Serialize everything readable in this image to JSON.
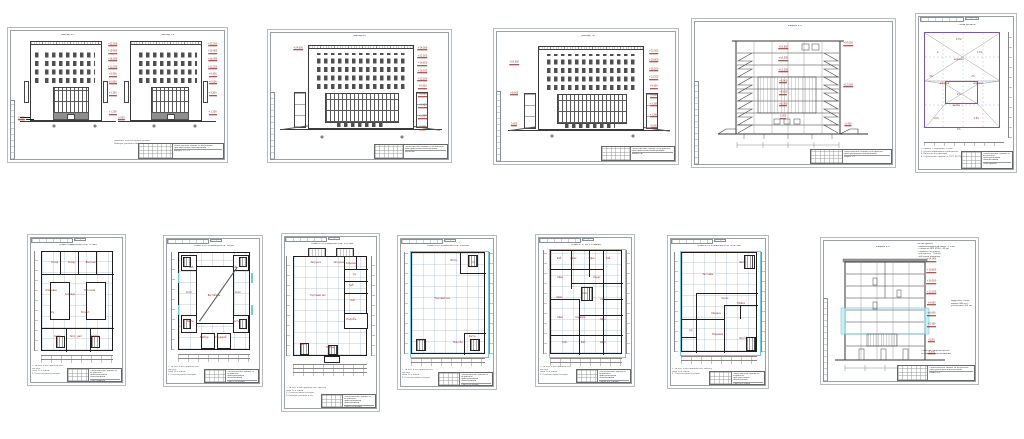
{
  "titleblock": {
    "proj": "Общественное здание со встроенно-\nпристроенными помещениями",
    "list": "Стадия АР  Лист"
  },
  "sheets": {
    "s1": {
      "title_left": "Фасад 1-7",
      "title_right": "Фасад 7-1",
      "stamp": "Фасады 1-7, 7-1",
      "note": "Указания: отметки даны в метрах.\nРазмеры указаны в миллиметрах.",
      "levels": [
        {
          "x": 103,
          "y": 6,
          "t": "+22.500",
          "c": "lvl"
        },
        {
          "x": 103,
          "y": 14,
          "t": "+19.800",
          "c": "lvl"
        },
        {
          "x": 103,
          "y": 22,
          "t": "+16.500",
          "c": "lvl"
        },
        {
          "x": 103,
          "y": 30,
          "t": "+13.200",
          "c": "lvl"
        },
        {
          "x": 103,
          "y": 38,
          "t": "+9.900",
          "c": "lvl"
        },
        {
          "x": 103,
          "y": 46,
          "t": "+6.600",
          "c": "lvl"
        },
        {
          "x": 103,
          "y": 58,
          "t": "+3.300",
          "c": "lvl"
        },
        {
          "x": 103,
          "y": 78,
          "t": "+1.200",
          "c": "lvl"
        },
        {
          "x": -3,
          "y": 84,
          "t": "0.000",
          "c": "lvl"
        },
        {
          "x": 35,
          "y": 92,
          "t": "",
          "c": "axc"
        },
        {
          "x": 83,
          "y": 92,
          "t": "",
          "c": "axc"
        }
      ]
    },
    "s2": {
      "title": "Фасад А-Г",
      "stamp": "Фасад А-Г",
      "levels": [
        {
          "x": 86,
          "y": 8,
          "t": "+24.000",
          "c": "lvl"
        },
        {
          "x": 86,
          "y": 15,
          "t": "+22.500",
          "c": "lvl"
        },
        {
          "x": 86,
          "y": 22,
          "t": "+19.800",
          "c": "lvl"
        },
        {
          "x": 86,
          "y": 29,
          "t": "+16.500",
          "c": "lvl"
        },
        {
          "x": 86,
          "y": 36,
          "t": "+13.200",
          "c": "lvl"
        },
        {
          "x": 86,
          "y": 43,
          "t": "+9.900",
          "c": "lvl"
        },
        {
          "x": 86,
          "y": 50,
          "t": "+6.600",
          "c": "lvl"
        },
        {
          "x": 86,
          "y": 60,
          "t": "+3.300",
          "c": "lvl"
        },
        {
          "x": 86,
          "y": 70,
          "t": "+1.200",
          "c": "lvl"
        },
        {
          "x": 86,
          "y": 80,
          "t": "0.000",
          "c": "lvl"
        },
        {
          "x": 12,
          "y": 8,
          "t": "+24.000",
          "c": "lvl"
        },
        {
          "x": 26,
          "y": 88,
          "t": "",
          "c": "axc"
        },
        {
          "x": 74,
          "y": 88,
          "t": "",
          "c": "axc"
        }
      ]
    },
    "s3": {
      "title": "Фасад Г-А",
      "stamp": "Фасад Г-А",
      "levels": [
        {
          "x": 88,
          "y": 10,
          "t": "+22.500",
          "c": "lvl"
        },
        {
          "x": 88,
          "y": 18,
          "t": "+19.800",
          "c": "lvl"
        },
        {
          "x": 88,
          "y": 26,
          "t": "+16.500",
          "c": "lvl"
        },
        {
          "x": 88,
          "y": 34,
          "t": "+13.200",
          "c": "lvl"
        },
        {
          "x": 88,
          "y": 42,
          "t": "+9.900",
          "c": "lvl"
        },
        {
          "x": 88,
          "y": 50,
          "t": "+6.600",
          "c": "lvl"
        },
        {
          "x": 88,
          "y": 58,
          "t": "+3.300",
          "c": "lvl"
        },
        {
          "x": 88,
          "y": 68,
          "t": "+1.200",
          "c": "lvl"
        },
        {
          "x": 88,
          "y": 78,
          "t": "0.000",
          "c": "lvl"
        },
        {
          "x": 6,
          "y": 20,
          "t": "+19.800",
          "c": "lvl"
        },
        {
          "x": 6,
          "y": 48,
          "t": "+9.900",
          "c": "lvl"
        },
        {
          "x": 6,
          "y": 76,
          "t": "0.000",
          "c": "lvl"
        },
        {
          "x": 28,
          "y": 86,
          "t": "",
          "c": "axc"
        },
        {
          "x": 76,
          "y": 86,
          "t": "",
          "c": "axc"
        }
      ]
    },
    "s4": {
      "title": "Разрез 1-1",
      "stamp": "Разрез 1-1",
      "levels": [
        {
          "x": 44,
          "y": 15,
          "t": "+19.800",
          "c": "lvl"
        },
        {
          "x": 44,
          "y": 24,
          "t": "+16.500",
          "c": "lvl"
        },
        {
          "x": 44,
          "y": 33,
          "t": "+13.200",
          "c": "lvl"
        },
        {
          "x": 44,
          "y": 42,
          "t": "+9.900",
          "c": "lvl"
        },
        {
          "x": 44,
          "y": 51,
          "t": "+6.600",
          "c": "lvl"
        },
        {
          "x": 44,
          "y": 60,
          "t": "+3.300",
          "c": "lvl"
        },
        {
          "x": 44,
          "y": 70,
          "t": "0.000",
          "c": "lvl"
        },
        {
          "x": 80,
          "y": 12,
          "t": "+24.000",
          "c": "lvl"
        },
        {
          "x": 80,
          "y": 45,
          "t": "+12.000",
          "c": "lvl"
        },
        {
          "x": 80,
          "y": 76,
          "t": "-0.450",
          "c": "lvl"
        }
      ]
    },
    "s5": {
      "title": "План кровли",
      "stamp": "План кровли",
      "note": "1. Кровля — рулонная, 2 слоя.\n2. Уклоны образованы керамзитом.\n3. Водосток внутренний.\n4. Ограждение кровли по ГОСТ 25772.",
      "labels": [
        {
          "x": 45,
          "y": 10,
          "t": "1.5%"
        },
        {
          "x": 20,
          "y": 22,
          "t": "в"
        },
        {
          "x": 70,
          "y": 22,
          "t": "1.5%"
        },
        {
          "x": 45,
          "y": 28,
          "t": "воронка"
        },
        {
          "x": 12,
          "y": 44,
          "t": "2%"
        },
        {
          "x": 62,
          "y": 44,
          "t": "2%"
        },
        {
          "x": 28,
          "y": 50,
          "t": "воронка"
        },
        {
          "x": 68,
          "y": 50,
          "t": "воронка"
        },
        {
          "x": 45,
          "y": 60,
          "t": "2%"
        },
        {
          "x": 42,
          "y": 70,
          "t": "выход"
        },
        {
          "x": 18,
          "y": 82,
          "t": "1.5%"
        },
        {
          "x": 66,
          "y": 82,
          "t": "1.5%"
        },
        {
          "x": 45,
          "y": 92,
          "t": "2%"
        }
      ]
    },
    "b1": {
      "title": "План подвала на отм. -3.300",
      "stamp": "План подвала",
      "note": "1. За отм. 0.000 принята отм. чистого\nпола 1-го этажа.\n2. Отметки даны в метрах.",
      "labels": [
        {
          "x": 18,
          "y": 11,
          "t": "Склад"
        },
        {
          "x": 42,
          "y": 11,
          "t": "Склад"
        },
        {
          "x": 70,
          "y": 11,
          "t": "Венткам."
        },
        {
          "x": 13,
          "y": 40,
          "t": "Кладовая"
        },
        {
          "x": 40,
          "y": 44,
          "t": "Коридор"
        },
        {
          "x": 68,
          "y": 40,
          "t": "Насосная"
        },
        {
          "x": 15,
          "y": 62,
          "t": "С/у"
        },
        {
          "x": 62,
          "y": 62,
          "t": "Эл.щит."
        },
        {
          "x": 22,
          "y": 87,
          "t": "Склад"
        },
        {
          "x": 48,
          "y": 87,
          "t": "Тепл. узел"
        },
        {
          "x": 76,
          "y": 87,
          "t": "Тамбур"
        }
      ]
    },
    "b2": {
      "title": "План 1-го этажа на отм. 0.000",
      "stamp": "План 1-го этажа",
      "note": "1. За отм. 0.000 принята отм. чистого\nпола 1-го этажа.\n2. Отметки даны в метрах.",
      "labels": [
        {
          "x": 18,
          "y": 16,
          "t": "Каб."
        },
        {
          "x": 80,
          "y": 16,
          "t": "Каб."
        },
        {
          "x": 14,
          "y": 42,
          "t": "Холл"
        },
        {
          "x": 50,
          "y": 45,
          "t": "Вестибюль"
        },
        {
          "x": 84,
          "y": 42,
          "t": "Холл"
        },
        {
          "x": 16,
          "y": 72,
          "t": "Лестн."
        },
        {
          "x": 82,
          "y": 72,
          "t": "Лестн."
        },
        {
          "x": 36,
          "y": 89,
          "t": "Тамбур"
        },
        {
          "x": 60,
          "y": 89,
          "t": "Гардероб"
        }
      ]
    },
    "b3": {
      "title": "План 2-го этажа на отм. +3.300",
      "stamp": "План 2-го этажа",
      "note": "1. За отм. 0.000 принята отм. чистого\nпола 1-го этажа.\n2. Отметки даны в метрах.\n3. Размеры указаны в мм.",
      "labels": [
        {
          "x": 30,
          "y": 6,
          "t": "Загрузка"
        },
        {
          "x": 62,
          "y": 6,
          "t": "Загрузка"
        },
        {
          "x": 33,
          "y": 40,
          "t": "Торговый зал"
        },
        {
          "x": 80,
          "y": 7,
          "t": "Кладовая"
        },
        {
          "x": 84,
          "y": 18,
          "t": "С/у"
        },
        {
          "x": 80,
          "y": 30,
          "t": "Каб."
        },
        {
          "x": 82,
          "y": 45,
          "t": "Каб."
        },
        {
          "x": 80,
          "y": 64,
          "t": "Подсобн."
        },
        {
          "x": 13,
          "y": 90,
          "t": "Лестн."
        },
        {
          "x": 50,
          "y": 93,
          "t": "Тамбур"
        }
      ]
    },
    "b4": {
      "title": "План 3-го этажа на отм. +6.600",
      "stamp": "План 3-го этажа",
      "note": "1. За отм. 0.000 принята отм. чистого\nпола 1-го этажа.\n2. Отметки даны в метрах.",
      "labels": [
        {
          "x": 42,
          "y": 46,
          "t": "Торговый зал"
        },
        {
          "x": 58,
          "y": 8,
          "t": "Лестн."
        },
        {
          "x": 85,
          "y": 10,
          "t": "С/у"
        },
        {
          "x": 12,
          "y": 88,
          "t": "Лестн."
        },
        {
          "x": 84,
          "y": 84,
          "t": "Лестн."
        },
        {
          "x": 64,
          "y": 90,
          "t": "Подсобн."
        }
      ]
    },
    "b5": {
      "title": "План 4, 5, 6-го этажей",
      "stamp": "Планы 4-6 этажей",
      "note": "1. За отм. 0.000 принята отм. чистого\nпола 1-го этажа.\n2. Отметки даны в метрах.",
      "labels": [
        {
          "x": 12,
          "y": 8,
          "t": "Каб."
        },
        {
          "x": 32,
          "y": 8,
          "t": "Офис"
        },
        {
          "x": 58,
          "y": 8,
          "t": "Офис"
        },
        {
          "x": 82,
          "y": 8,
          "t": "Каб."
        },
        {
          "x": 13,
          "y": 26,
          "t": "Офис"
        },
        {
          "x": 66,
          "y": 26,
          "t": "Перег."
        },
        {
          "x": 12,
          "y": 46,
          "t": "Офис"
        },
        {
          "x": 48,
          "y": 42,
          "t": "Холл"
        },
        {
          "x": 74,
          "y": 48,
          "t": "Каб."
        },
        {
          "x": 13,
          "y": 66,
          "t": "Офис"
        },
        {
          "x": 42,
          "y": 66,
          "t": "Коридор"
        },
        {
          "x": 74,
          "y": 68,
          "t": "Офис"
        },
        {
          "x": 20,
          "y": 90,
          "t": "Каб."
        },
        {
          "x": 46,
          "y": 90,
          "t": "Каб."
        },
        {
          "x": 74,
          "y": 90,
          "t": "Офис"
        }
      ]
    },
    "b6": {
      "title": "План 6-го этажа на отм. +16.500",
      "stamp": "План 6-го этажа",
      "note": "1. За отм. 0.000 принята отм. чистого\nпола 1-го этажа.\n2. Отметки даны в метрах.",
      "labels": [
        {
          "x": 35,
          "y": 22,
          "t": "Зал кафе"
        },
        {
          "x": 82,
          "y": 10,
          "t": "Лестн."
        },
        {
          "x": 58,
          "y": 47,
          "t": "Кухня"
        },
        {
          "x": 80,
          "y": 52,
          "t": "Мойка"
        },
        {
          "x": 46,
          "y": 62,
          "t": "Раздача"
        },
        {
          "x": 12,
          "y": 80,
          "t": "С/у"
        },
        {
          "x": 48,
          "y": 84,
          "t": "Кладовая"
        },
        {
          "x": 82,
          "y": 88,
          "t": "Лестн."
        }
      ]
    },
    "b7": {
      "title": "Разрез 2-2",
      "stamp": "Разрез 2-2",
      "ann_top": "Состав кровли:\n– водоизоляционный ковер – 2 слоя\n– стяжка из ЦПР М150 – 40 мм\n– керамзит по уклону\n– утеплитель – 150 мм\n– ж/б плита покрытия",
      "ann_mid": "Наружные стены –\nкирпич 380 мм с\nутеплением 100 мм",
      "ann_low": "Отмостка – асфальтобетон\nпо щебеночному основанию",
      "levels": [
        {
          "x": 84,
          "y": 7,
          "t": "+24.000",
          "c": "lvl"
        },
        {
          "x": 84,
          "y": 16,
          "t": "+19.800",
          "c": "lvl"
        },
        {
          "x": 84,
          "y": 25,
          "t": "+16.500",
          "c": "lvl"
        },
        {
          "x": 84,
          "y": 34,
          "t": "+13.200",
          "c": "lvl"
        },
        {
          "x": 84,
          "y": 43,
          "t": "+9.900",
          "c": "lvl"
        },
        {
          "x": 84,
          "y": 52,
          "t": "+6.600",
          "c": "lvl"
        },
        {
          "x": 84,
          "y": 61,
          "t": "+3.300",
          "c": "lvl"
        },
        {
          "x": 84,
          "y": 74,
          "t": "0.000",
          "c": "lvl"
        },
        {
          "x": 84,
          "y": 84,
          "t": "-3.300",
          "c": "lvl"
        }
      ]
    }
  }
}
